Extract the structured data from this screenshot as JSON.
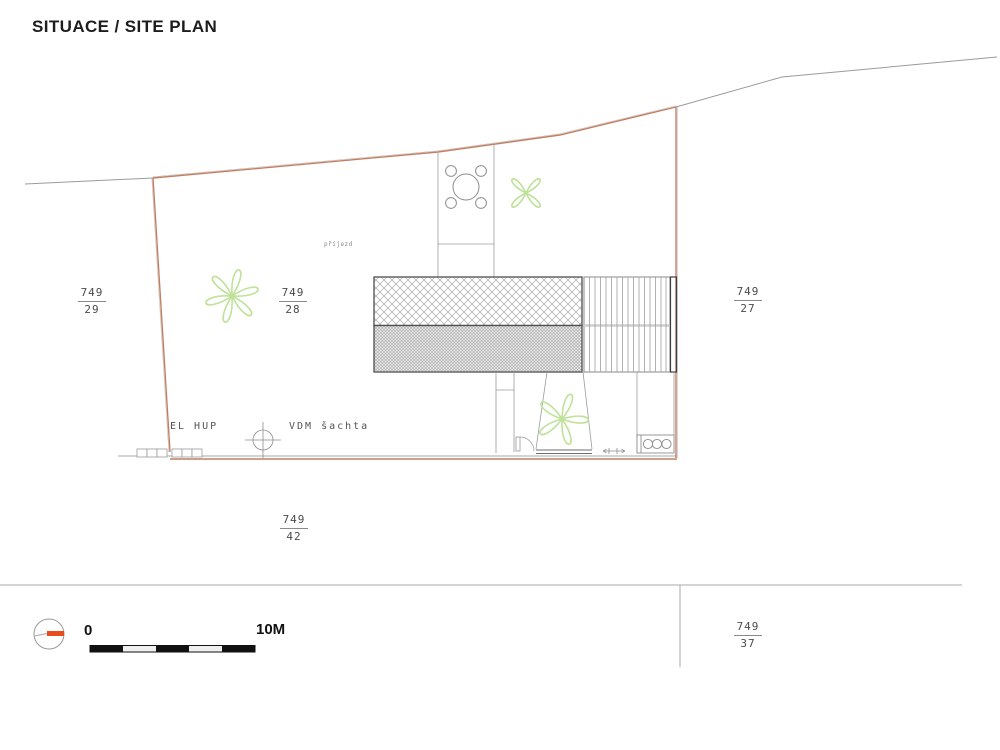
{
  "title": "SITUACE / SITE PLAN",
  "parcels": {
    "p29": {
      "num": "749",
      "den": "29"
    },
    "p28": {
      "num": "749",
      "den": "28"
    },
    "p27": {
      "num": "749",
      "den": "27"
    },
    "p42": {
      "num": "749",
      "den": "42"
    },
    "p37": {
      "num": "749",
      "den": "37"
    }
  },
  "annotations": {
    "el_hup": "EL HUP",
    "vdm_sachta": "VDM šachta",
    "prijezd": "příjezd"
  },
  "scale_bar": {
    "start_label": "0",
    "end_label": "10M"
  },
  "colors": {
    "boundary": "#c27f63",
    "north_red": "#e84b1d",
    "vegetation": "#bfe29b",
    "line_gray": "#9b9b9b",
    "building_edge": "#4f4f4f"
  },
  "symbols": [
    {
      "name": "north-indicator-icon"
    },
    {
      "name": "scale-bar"
    },
    {
      "name": "manhole-icon"
    },
    {
      "name": "table-chairs-icon"
    },
    {
      "name": "tree-icon"
    },
    {
      "name": "door-swing-icon"
    }
  ]
}
